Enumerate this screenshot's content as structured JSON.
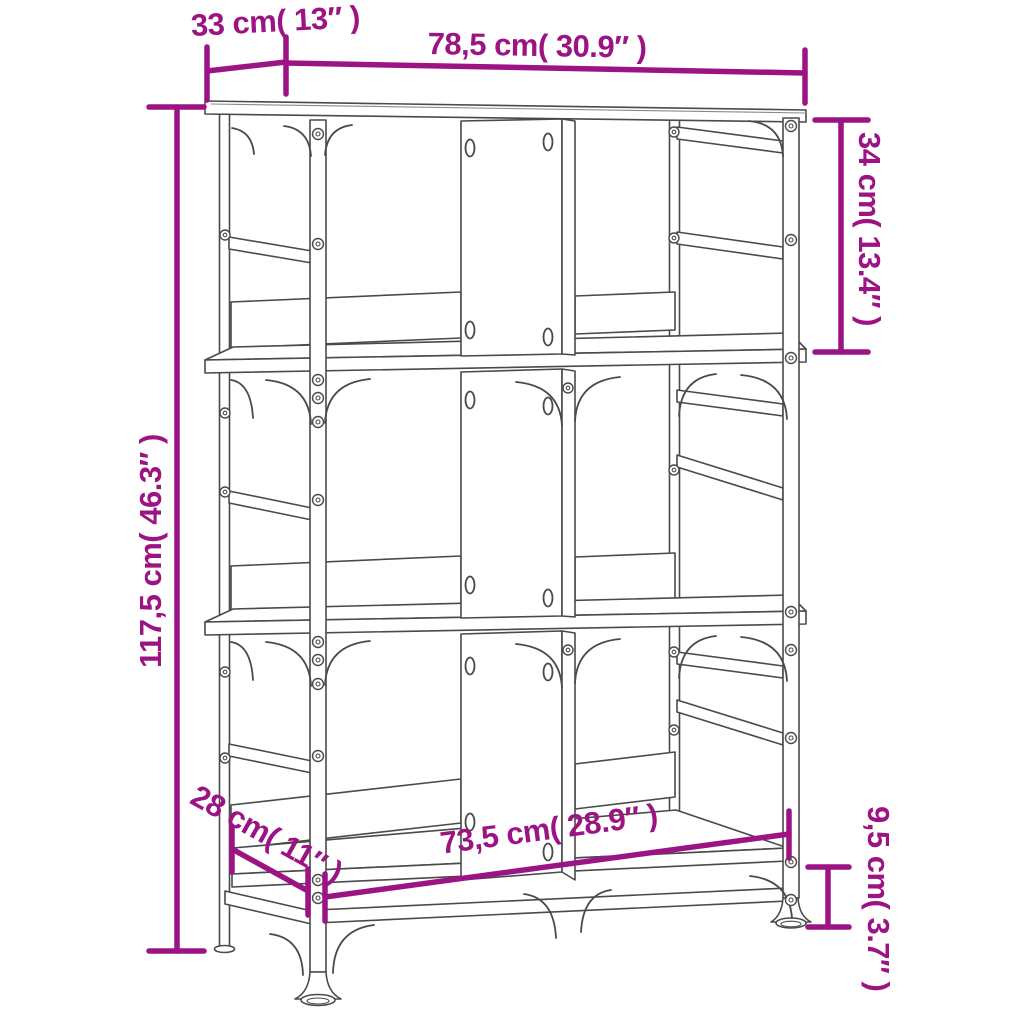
{
  "diagram": {
    "title": "bookshelf-dimension-diagram",
    "product": "3-tier industrial bookshelf line drawing",
    "accent_color": "#9C1484",
    "outline_color": "#4A4A4A",
    "background_color": "#FFFFFF",
    "labels": {
      "top_depth": "33 cm( 13″ )",
      "top_width": "78,5 cm( 30.9″ )",
      "top_tier_height": "34 cm( 13.4″ )",
      "total_height": "117,5 cm( 46.3″ )",
      "bottom_depth": "28 cm( 11″ )",
      "bottom_width": "73,5 cm( 28.9″ )",
      "ground_clearance": "9,5 cm( 3.7″ )"
    }
  }
}
